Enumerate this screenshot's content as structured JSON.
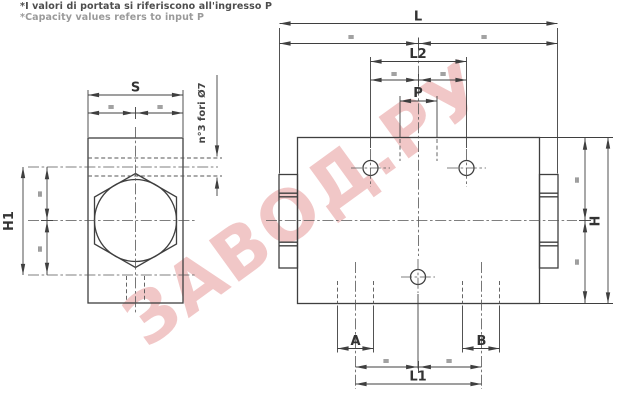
{
  "notes": {
    "line1": "*I valori di portata si riferiscono all'ingresso P",
    "line2": "*Capacity values refers to input P"
  },
  "watermark": {
    "text": "ЗАВОД.РУ",
    "color_hex": "#dd7373"
  },
  "labels": {
    "side_view": {
      "width": "S",
      "height": "H1",
      "holes_note": "n°3 fori Ø7"
    },
    "plan_view": {
      "overall_length": "L",
      "top_hole_spacing": "L2",
      "inlet_port": "P",
      "overall_height": "H",
      "port_a": "A",
      "port_b": "B",
      "bottom_hole_spacing": "L1"
    }
  },
  "marks": {
    "equal": "="
  },
  "drawing_line_color": "#3f3f3f"
}
